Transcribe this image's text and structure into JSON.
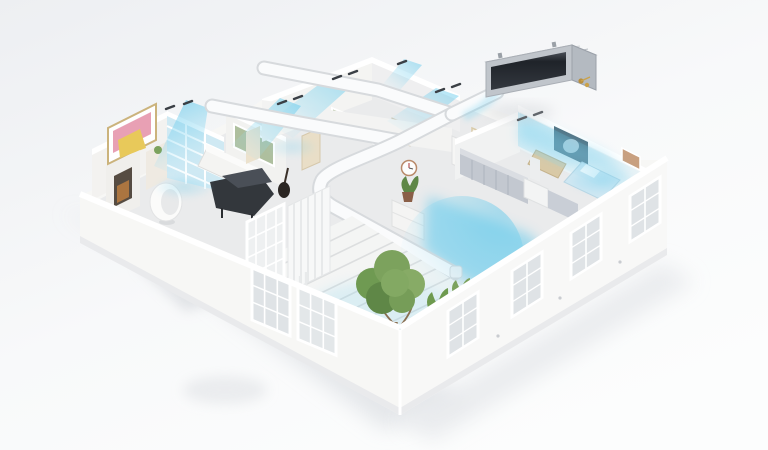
{
  "meta": {
    "description": "3D isometric cutaway illustration of a multi-room home cooled by a ceiling-concealed duct air conditioner; white ducts run above the ceilings and blue airflow sheets blow from hidden vents into every room",
    "alt": "Ducted air conditioner distributing cool air through a floor plan"
  },
  "colors": {
    "background_top": "#edeff2",
    "background_bottom": "#fcfdfd",
    "ground_shadow": "#dde0e4",
    "ground_shadow_dark": "#d2d5da",
    "wall_white": "#f7f7f5",
    "wall_shade": "#e9eaec",
    "wall_top": "#ffffff",
    "floor": "#eaebec",
    "terrace_floor": "#f4f5f4",
    "airflow_strong": "#45bfe8",
    "airflow_mid": "#7dd3f0",
    "airflow_soft": "#c8ecf9",
    "duct_fill": "#fafbfc",
    "duct_edge": "#d7dadd",
    "unit_body": "#c6cbd1",
    "unit_body_light": "#e3e6e9",
    "unit_grille": "#1f2329",
    "unit_pipe": "#b98f3e",
    "foliage": "#7ca25d",
    "foliage_dark": "#5f8747",
    "trunk": "#8a6f52",
    "piano": "#33373c",
    "art_pink": "#e8a0b4",
    "art_yellow": "#e8c95a",
    "art_green": "#aebf9e",
    "poster_teal": "#4e6d7d",
    "sofa_tan": "#d9c9a6",
    "bed_blue": "#cfe7f2",
    "cabinet_grey": "#c3c8d0",
    "glass": "#dfe3e6"
  },
  "scene": {
    "unit": "ceiling-concealed-duct-air-conditioner",
    "duct_runs": 4,
    "vent_count": 7,
    "rooms": [
      "living-room",
      "study",
      "hallway",
      "bedroom",
      "kitchen",
      "terrace"
    ]
  }
}
